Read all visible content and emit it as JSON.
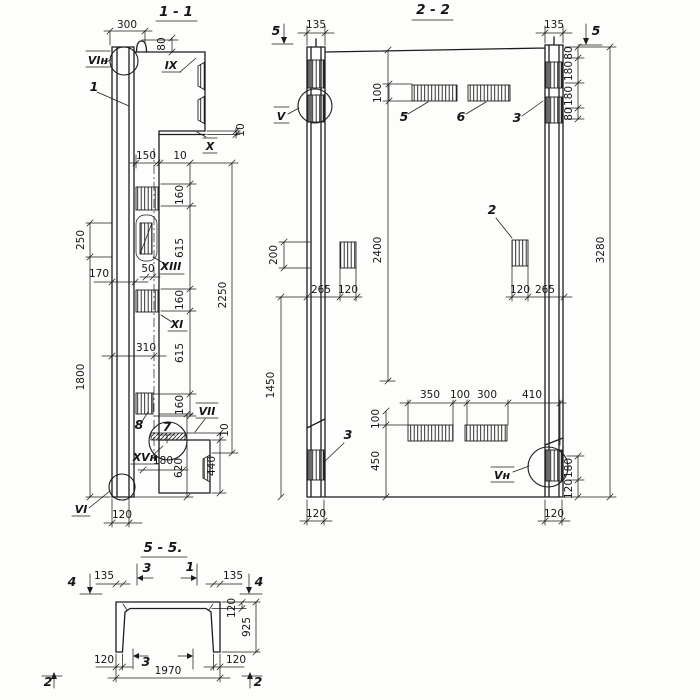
{
  "sections": {
    "s11": {
      "title": "1 - 1",
      "dims": {
        "d300": "300",
        "d80": "80",
        "d10_plate": "10",
        "d150": "150",
        "d10_rib": "10",
        "d160_1": "160",
        "d615_1": "615",
        "d160_2": "160",
        "d615_2": "615",
        "d160_3": "160",
        "d2250": "2250",
        "d250": "250",
        "d170": "170",
        "d50": "50",
        "d310": "310",
        "d1800": "1800",
        "d10_weld": "10",
        "d440": "440",
        "d180": "180",
        "d620": "620",
        "d120": "120"
      },
      "labels": {
        "vi_n": "VIн",
        "part_1": "1",
        "ix": "IX",
        "x": "X",
        "xiii": "XIII",
        "xi": "XI",
        "part_8": "8",
        "part_7": "7",
        "vii": "VII",
        "xv_n": "XVн",
        "vi": "VI"
      }
    },
    "s22": {
      "title": "2 - 2",
      "dims": {
        "d135_l": "135",
        "d135_r": "135",
        "d100_top": "100",
        "d80_1": "80",
        "d180_1": "180",
        "d180_2": "180",
        "d80_2": "80",
        "d200": "200",
        "d2400": "2400",
        "d3280": "3280",
        "d265_l": "265",
        "d120_l": "120",
        "d120_r": "120",
        "d265_r": "265",
        "d1450": "1450",
        "d350": "350",
        "d100_mid": "100",
        "d300": "300",
        "d410": "410",
        "d100_bl": "100",
        "d450": "450",
        "d180_br": "180",
        "d120_br": "120",
        "d120_bot_l": "120",
        "d120_bot_r": "120"
      },
      "labels": {
        "marker5_l": "5",
        "marker5_r": "5",
        "v": "V",
        "part_5": "5",
        "part_6": "6",
        "part_3_top": "3",
        "part_2": "2",
        "part_3_bot": "3",
        "v_n": "Vн"
      }
    },
    "s55": {
      "title": "5 - 5.",
      "dims": {
        "d135_l": "135",
        "d135_r": "135",
        "d120_slab": "120",
        "d925": "925",
        "d120_leg_l": "120",
        "d120_leg_r": "120",
        "d1970": "1970"
      },
      "labels": {
        "marker4_l": "4",
        "marker4_r": "4",
        "cut3_top": "3",
        "cut1_top": "1",
        "cut3_bot": "3",
        "marker2_l": "2",
        "marker2_r": "2"
      }
    }
  }
}
